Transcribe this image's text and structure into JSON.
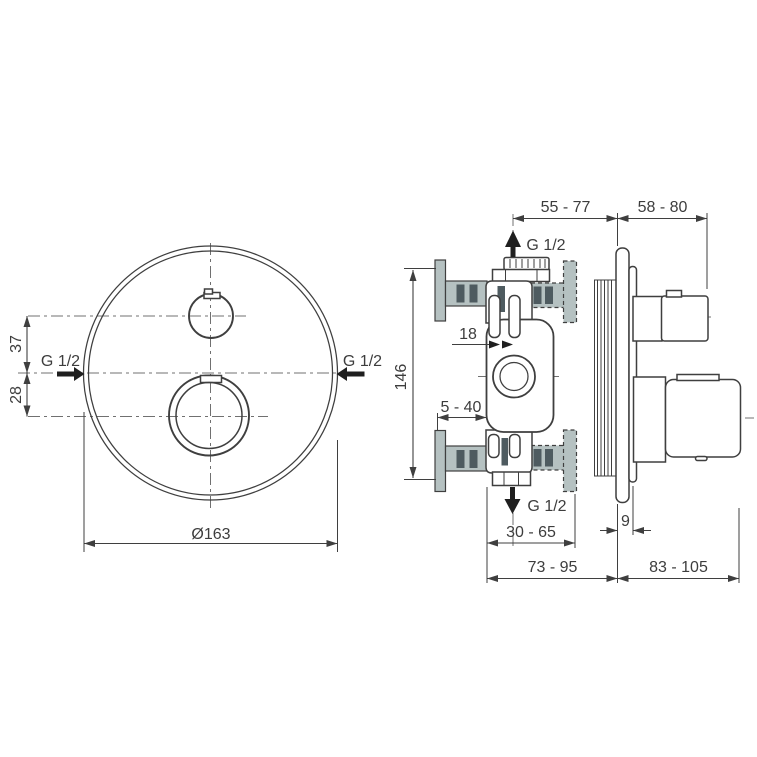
{
  "drawing_title": "Built-in thermostatic mixer dimensional drawing",
  "front": {
    "diameter": "Ø163",
    "offset_top": "37",
    "offset_bottom": "28",
    "inlet_left": "G 1/2",
    "inlet_right": "G 1/2"
  },
  "side": {
    "depth_front": "55 - 77",
    "depth_handle": "58 - 80",
    "outlet_top": "G 1/2",
    "outlet_bottom": "G 1/2",
    "center_offset": "18",
    "height_total": "146",
    "wall_min": "5 - 40",
    "wall_range": "30 - 65",
    "plate_thickness": "9",
    "depth_body": "73 - 95",
    "depth_trim": "83 - 105"
  },
  "colors": {
    "line": "#3f3f3f",
    "center": "#707070",
    "wall": "#b5c1c1",
    "stud": "#4e5b60",
    "text": "#3d3d3d",
    "solid": "#1f1f1f",
    "background": "#ffffff"
  }
}
